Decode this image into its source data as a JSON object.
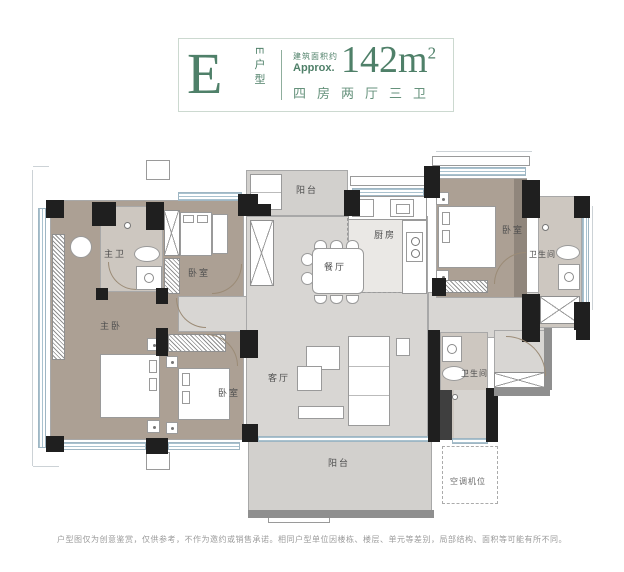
{
  "header": {
    "unit_letter": "E",
    "unit_type_vertical": "E户型",
    "area_prefix": "建筑面积约",
    "area_approx": "Approx.",
    "area_value": "142m",
    "area_sup": "2",
    "layout_text": "四房两厅三卫"
  },
  "rooms": {
    "balcony_top": "阳台",
    "kitchen": "厨房",
    "dining": "餐厅",
    "master_bath": "主卫",
    "bedroom2": "卧室",
    "master_bedroom": "主卧",
    "bedroom3": "卧室",
    "living": "客厅",
    "bedroom4": "卧室",
    "bath_right": "卫生间",
    "bath_mid": "卫生间",
    "balcony_bottom": "阳台",
    "ac_unit": "空调机位"
  },
  "footer": {
    "disclaimer": "户型图仅为创意鉴赏，仅供参考，不作为邀约或销售承诺。相同户型单位因楼栋、楼层、单元等差别，局部结构、面积等可能有所不同。"
  },
  "colors": {
    "brand_green": "#4f8069",
    "border_green": "#ccd9d0",
    "wall_black": "#1f1f1f",
    "wall_gray": "#8f8f8f",
    "window_blue": "#a9c2cf",
    "floor_wood": "#aca094",
    "floor_marble": "#d8d6d3",
    "floor_tile": "#cdc7c0",
    "label_gray": "#4e4e4e"
  }
}
